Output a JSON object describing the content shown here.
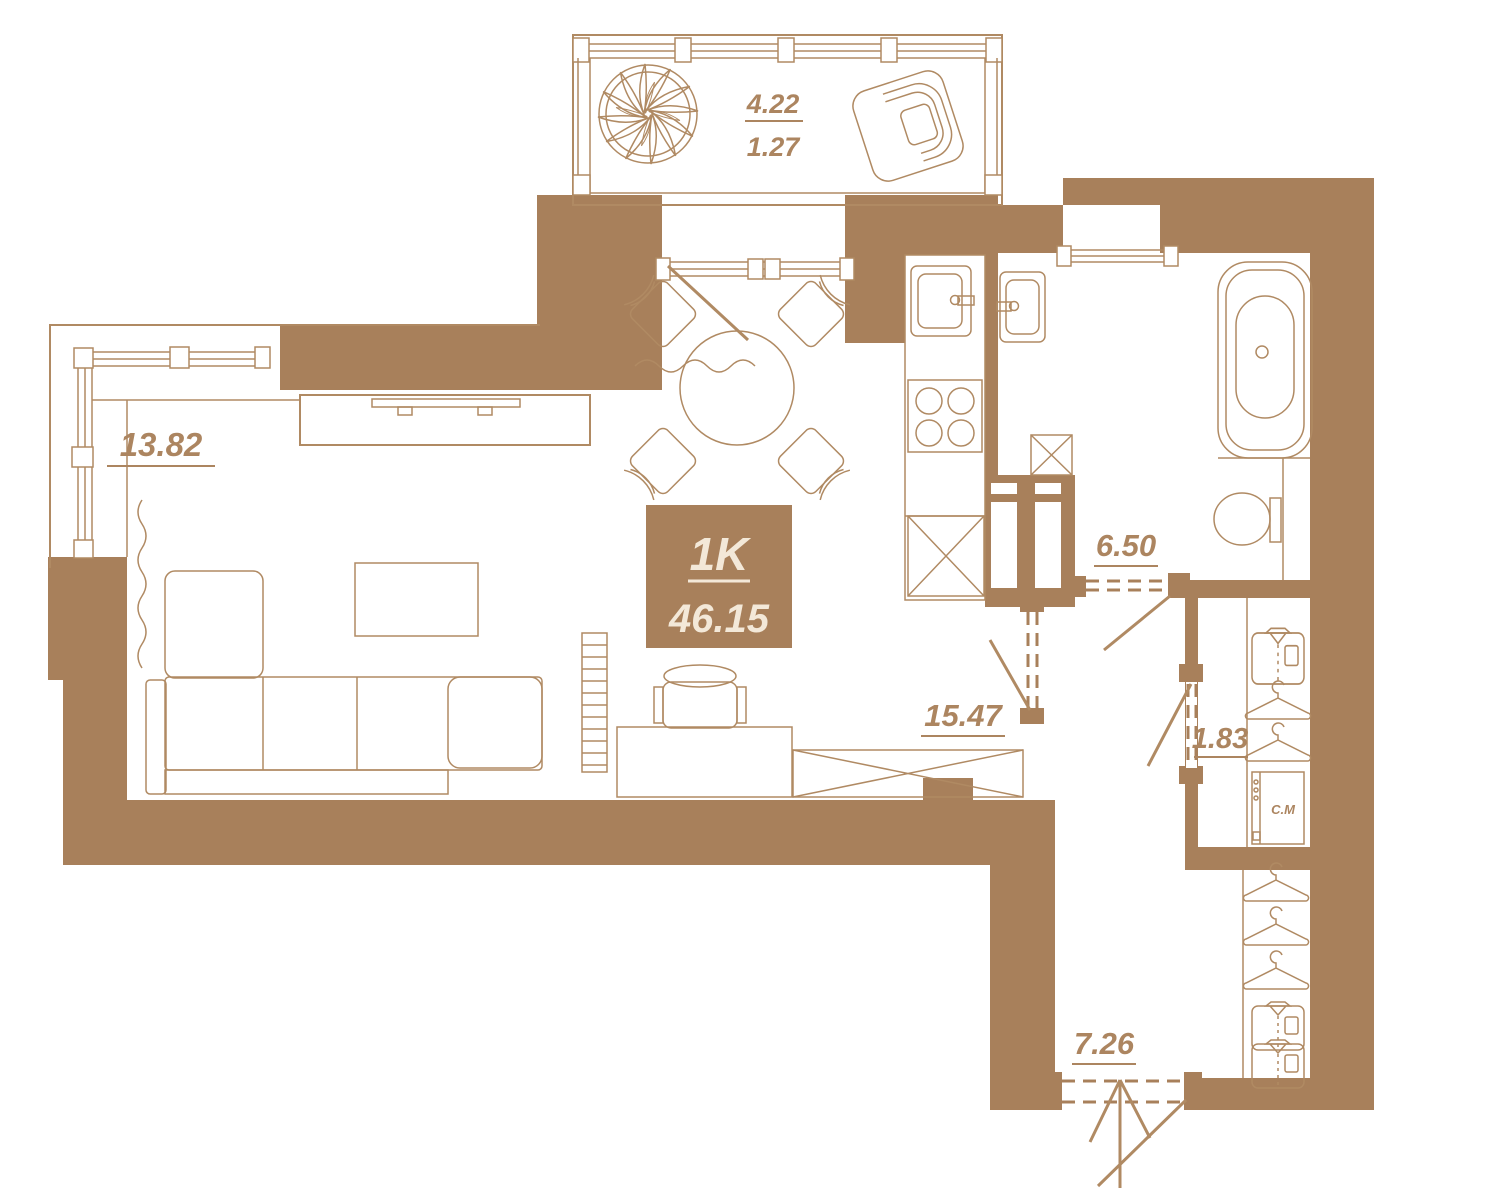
{
  "plan": {
    "unit_type": "1K",
    "total_area": "46.15",
    "rooms": {
      "living": "13.82",
      "kitchen_living": "15.47",
      "bathroom": "6.50",
      "wardrobe": "1.83",
      "hallway": "7.26",
      "balcony_full": "4.22",
      "balcony_reduced": "1.27"
    },
    "appliances": {
      "washing_machine": "С.М"
    },
    "colors": {
      "wall": "#a8805b",
      "line": "#b08a63",
      "label_text": "#ac8560",
      "badge_background": "#a8805b",
      "badge_text": "#f3e8d8",
      "paper": "#ffffff"
    }
  }
}
